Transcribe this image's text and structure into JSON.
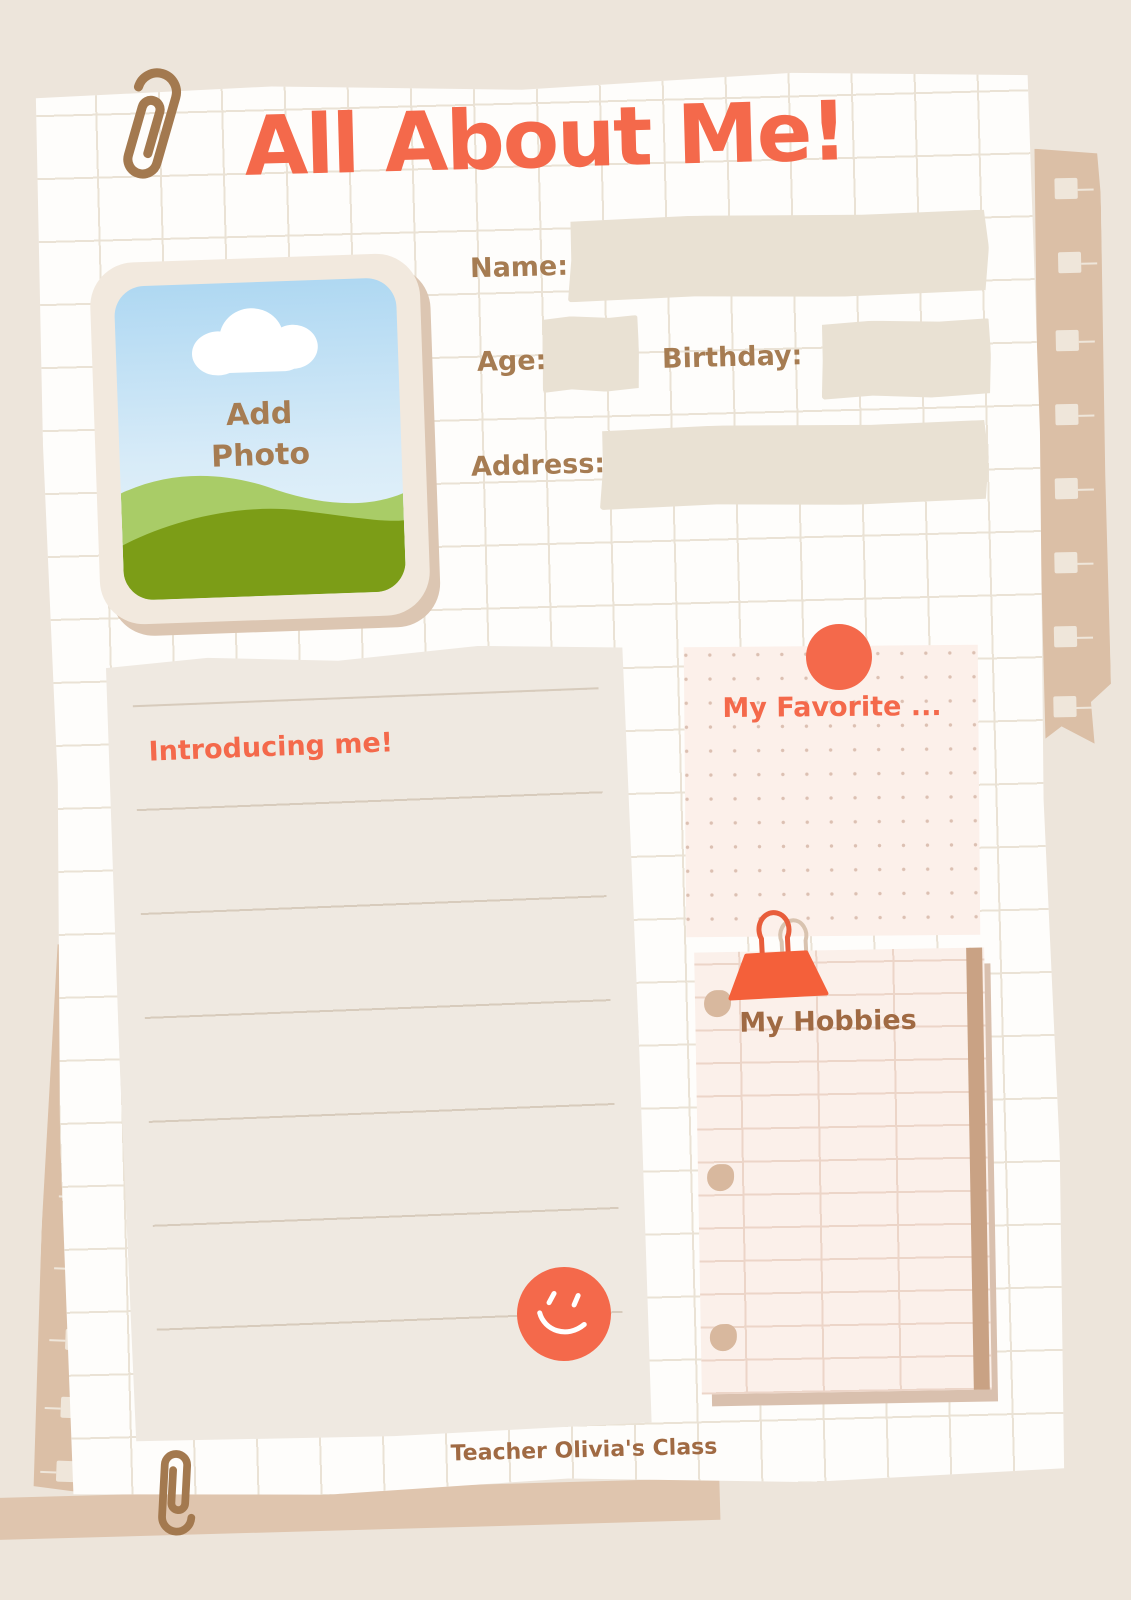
{
  "title": {
    "text": "All About Me!",
    "color": "#F4694B"
  },
  "photo": {
    "label": "Add Photo"
  },
  "form": {
    "name_label": "Name:",
    "age_label": "Age:",
    "birthday_label": "Birthday:",
    "address_label": "Address:"
  },
  "intro": {
    "title": "Introducing me!"
  },
  "favorite": {
    "title": "My Favorite ..."
  },
  "hobbies": {
    "title": "My Hobbies"
  },
  "footer": {
    "text": "Teacher Olivia's Class"
  },
  "palette": {
    "background": "#EDE5DB",
    "coral_accent": "#F4694B",
    "brown_text": "#A67C52",
    "dark_brown_text": "#A06A43",
    "blank_field": "#E9E1D3",
    "grid_line": "#EAE2D5",
    "intro_paper": "#EFE9E1",
    "note_pink": "#FCF0EA",
    "tape_tan": "#DBBFA6",
    "shadow_tan": "#D9C0AE",
    "paperclip_brown": "#A3794F",
    "hill_light_green": "#A9CC67",
    "hill_dark_green": "#7C9D17",
    "sky_blue": "#AFD8F2"
  }
}
